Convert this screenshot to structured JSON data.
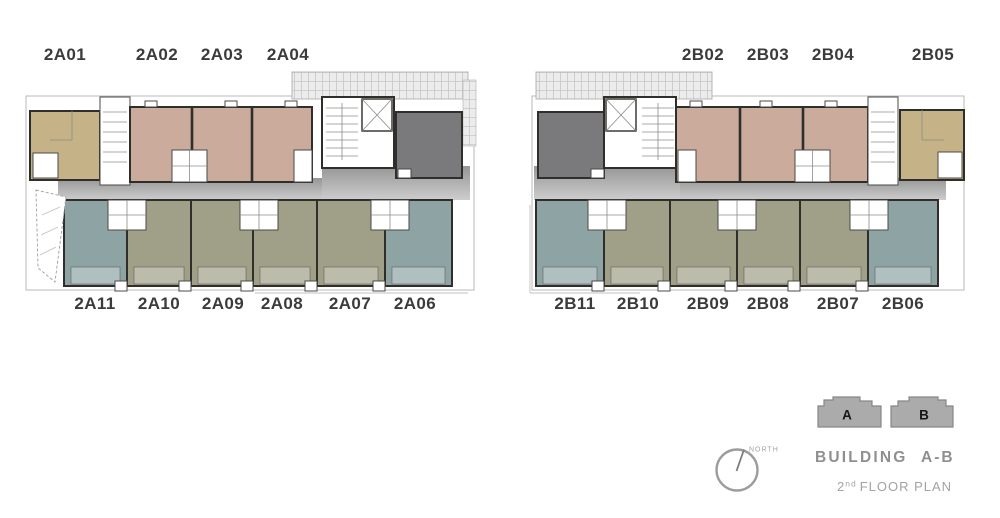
{
  "plans": [
    {
      "top_labels": [
        "2A01",
        "2A02",
        "2A03",
        "2A04"
      ],
      "bottom_labels": [
        "2A11",
        "2A10",
        "2A09",
        "2A08",
        "2A07",
        "2A06"
      ]
    },
    {
      "top_labels": [
        "2B02",
        "2B03",
        "2B04",
        "2B05"
      ],
      "bottom_labels": [
        "2B11",
        "2B10",
        "2B09",
        "2B08",
        "2B07",
        "2B06"
      ]
    }
  ],
  "legend": {
    "north_label": "NORTH",
    "icon_a_letter": "A",
    "icon_b_letter": "B",
    "building_word": "BUILDING",
    "building_range": "A-B",
    "floor_number": "2",
    "floor_ordinal": "nd",
    "floor_text": "FLOOR PLAN"
  },
  "colors": {
    "unit_tan": "#c5b287",
    "unit_pink": "#cbab9c",
    "unit_olive": "#9fa087",
    "unit_teal": "#8ea4a4",
    "unit_dark": "#7a7a7c",
    "corridor_dark": "#969696",
    "corridor_light": "#cdcdcd",
    "wall": "#2f2e2b",
    "label_text": "#3b3b3b",
    "legend_gray": "#8f8f8f"
  }
}
